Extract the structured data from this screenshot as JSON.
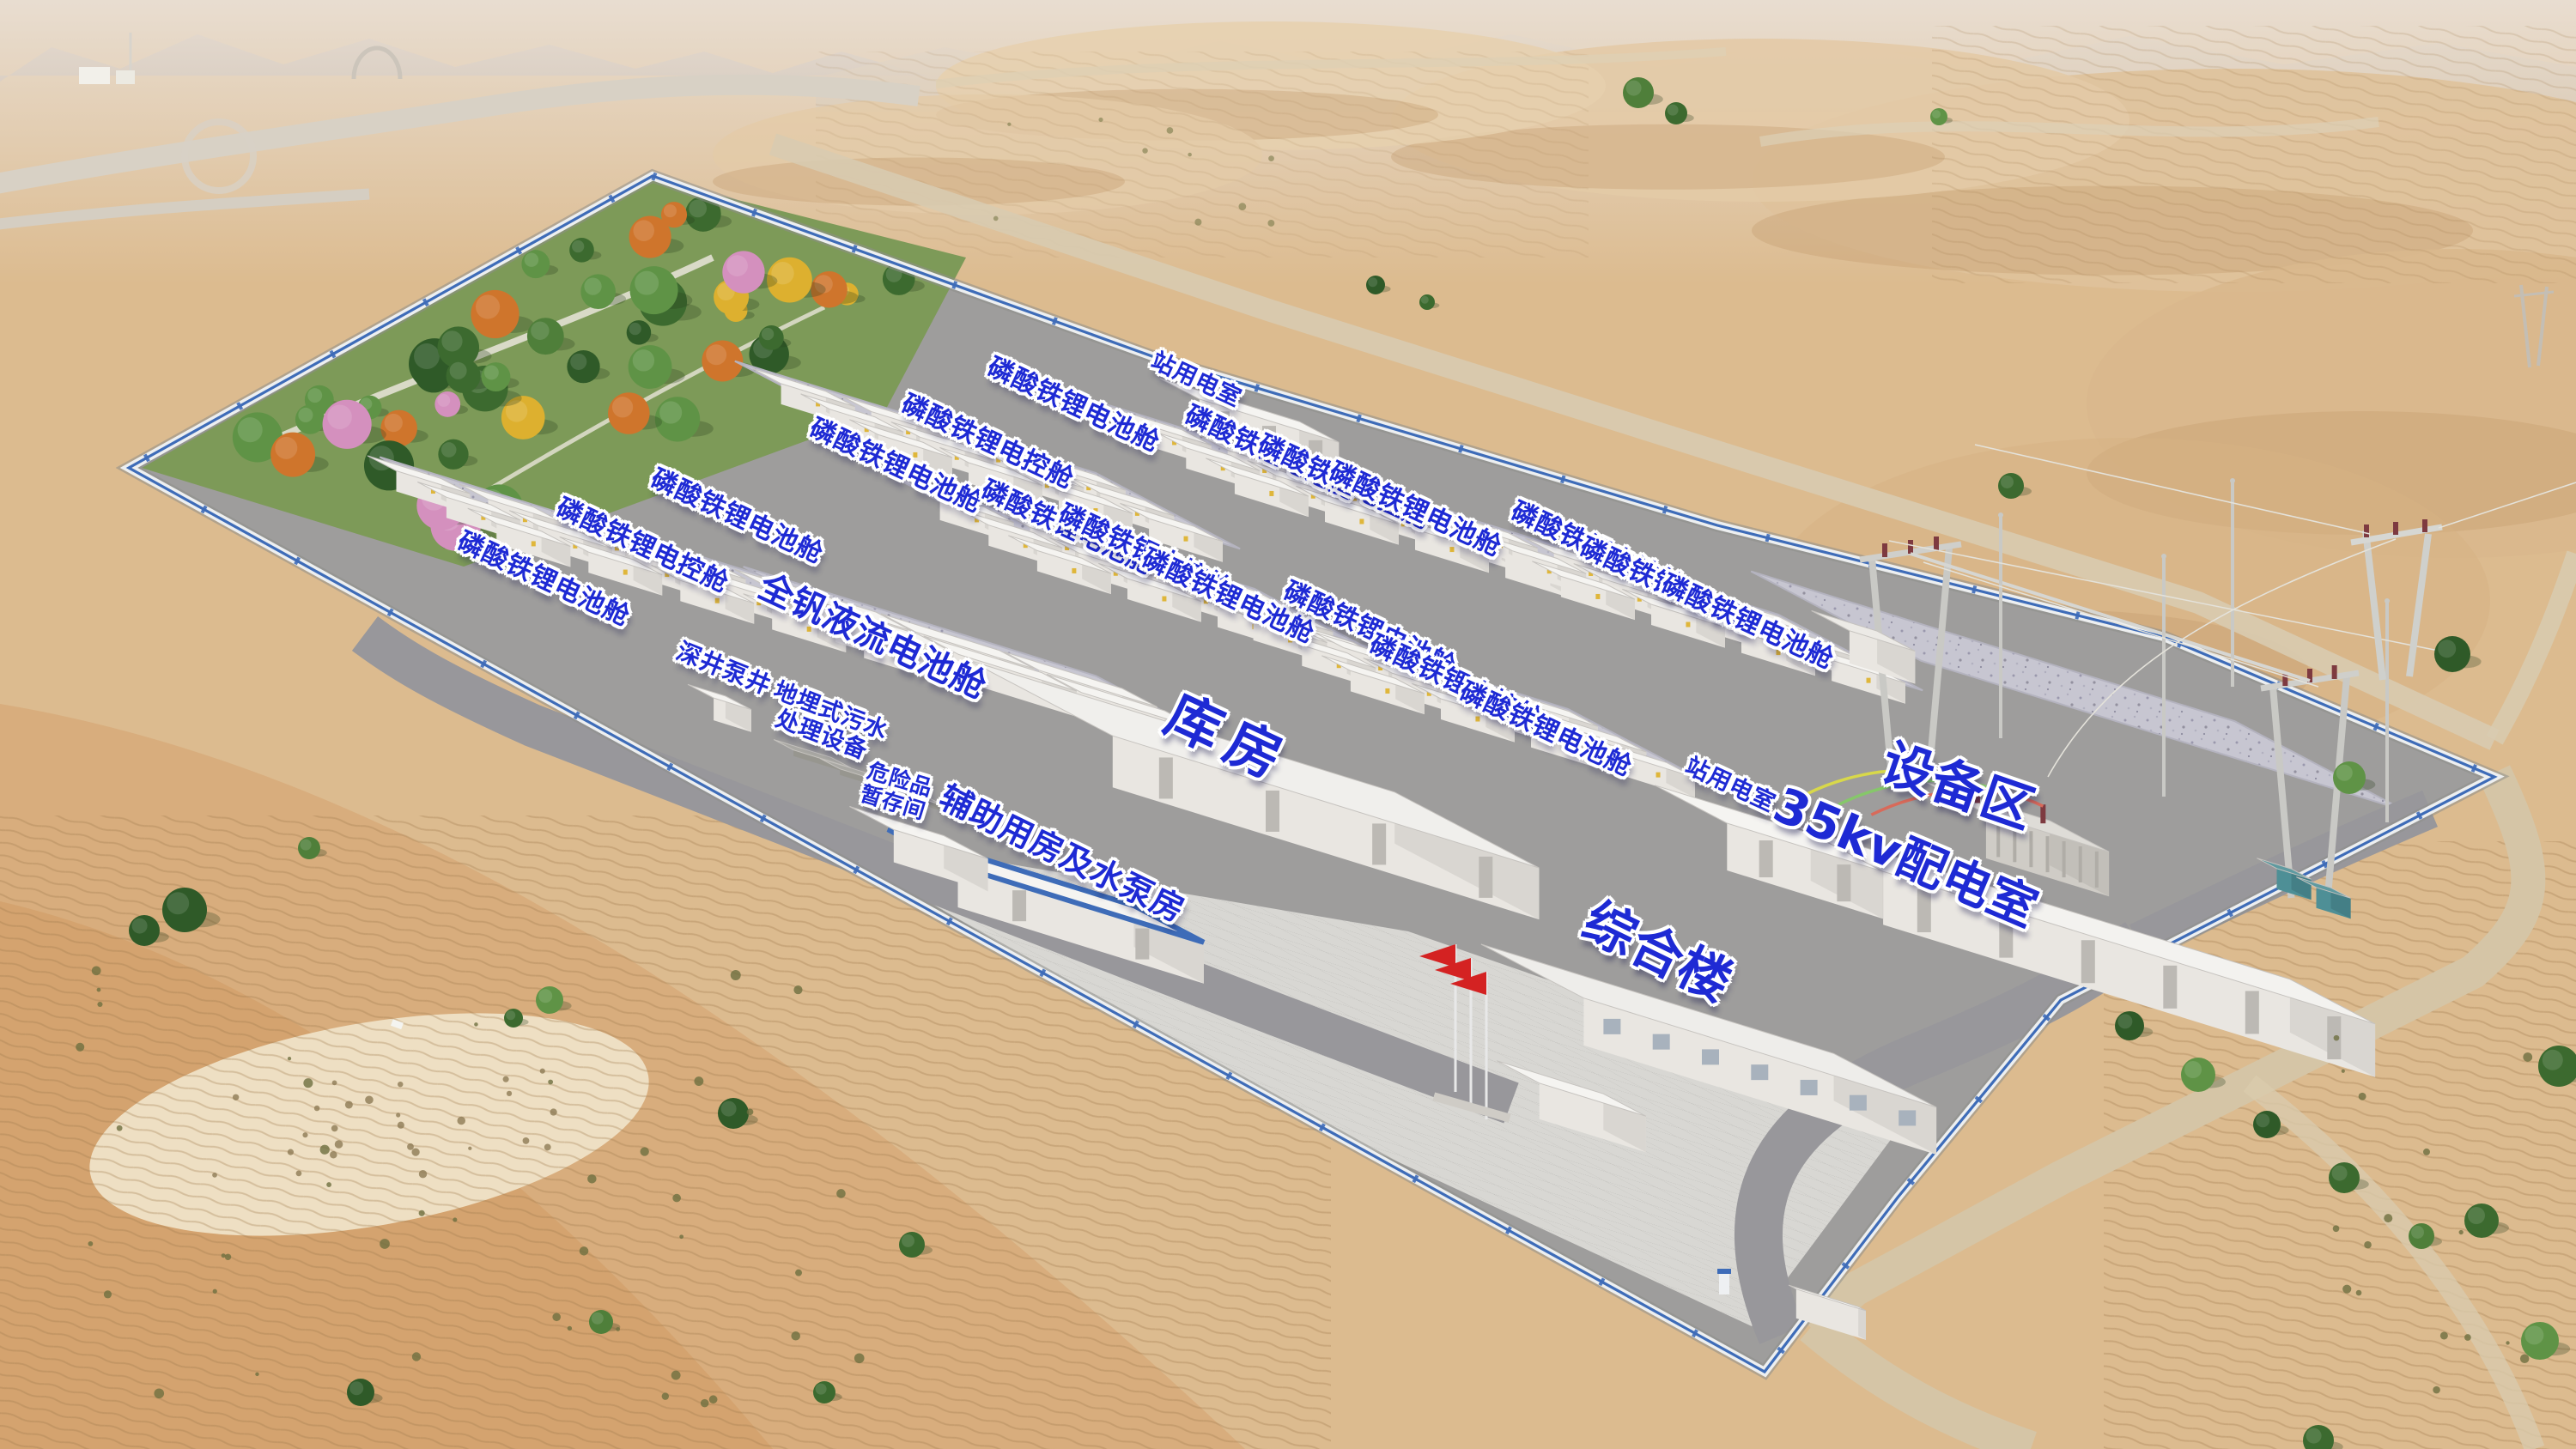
{
  "site": {
    "type": "energy-storage-power-station-aerial-rendering",
    "colors": {
      "label_blue": "#1e2ad4",
      "wall_blue": "#3e6cb8",
      "flag_red": "#d42222",
      "sand": "#d9b98c",
      "pad_concrete": "#c7c6d1",
      "asphalt": "#9e9d9c"
    }
  },
  "labels": [
    {
      "text": "站用电室"
    },
    {
      "text": "磷酸铁锂电池舱"
    },
    {
      "text": "磷酸铁锂电控舱"
    },
    {
      "text": "磷酸铁锂电池舱"
    },
    {
      "text": "磷酸铁锂电池舱"
    },
    {
      "text": "磷酸铁锂电控舱"
    },
    {
      "text": "磷酸铁锂电池舱"
    },
    {
      "text": "磷酸铁锂电池舱"
    },
    {
      "text": "磷酸铁锂电控舱"
    },
    {
      "text": "磷酸铁锂电池舱"
    },
    {
      "text": "磷酸铁锂电池舱"
    },
    {
      "text": "磷酸铁锂电控舱"
    },
    {
      "text": "磷酸铁锂电池舱"
    },
    {
      "text": "磷酸铁锂电池舱"
    },
    {
      "text": "磷酸铁锂电控舱"
    },
    {
      "text": "磷酸铁锂电池舱"
    },
    {
      "text": "磷酸铁锂电池舱"
    },
    {
      "text": "磷酸铁锂电控舱"
    },
    {
      "text": "磷酸铁锂电池舱"
    },
    {
      "text": "全钒液流电池舱"
    },
    {
      "text": "深井泵井"
    },
    {
      "text": "地埋式污水\n处理设备"
    },
    {
      "text": "危险品\n暂存间"
    },
    {
      "text": "辅助用房及水泵房"
    },
    {
      "text": "库房"
    },
    {
      "text": "综合楼"
    },
    {
      "text": "站用电室"
    },
    {
      "text": "35kv配电室"
    },
    {
      "text": "设备区"
    }
  ]
}
